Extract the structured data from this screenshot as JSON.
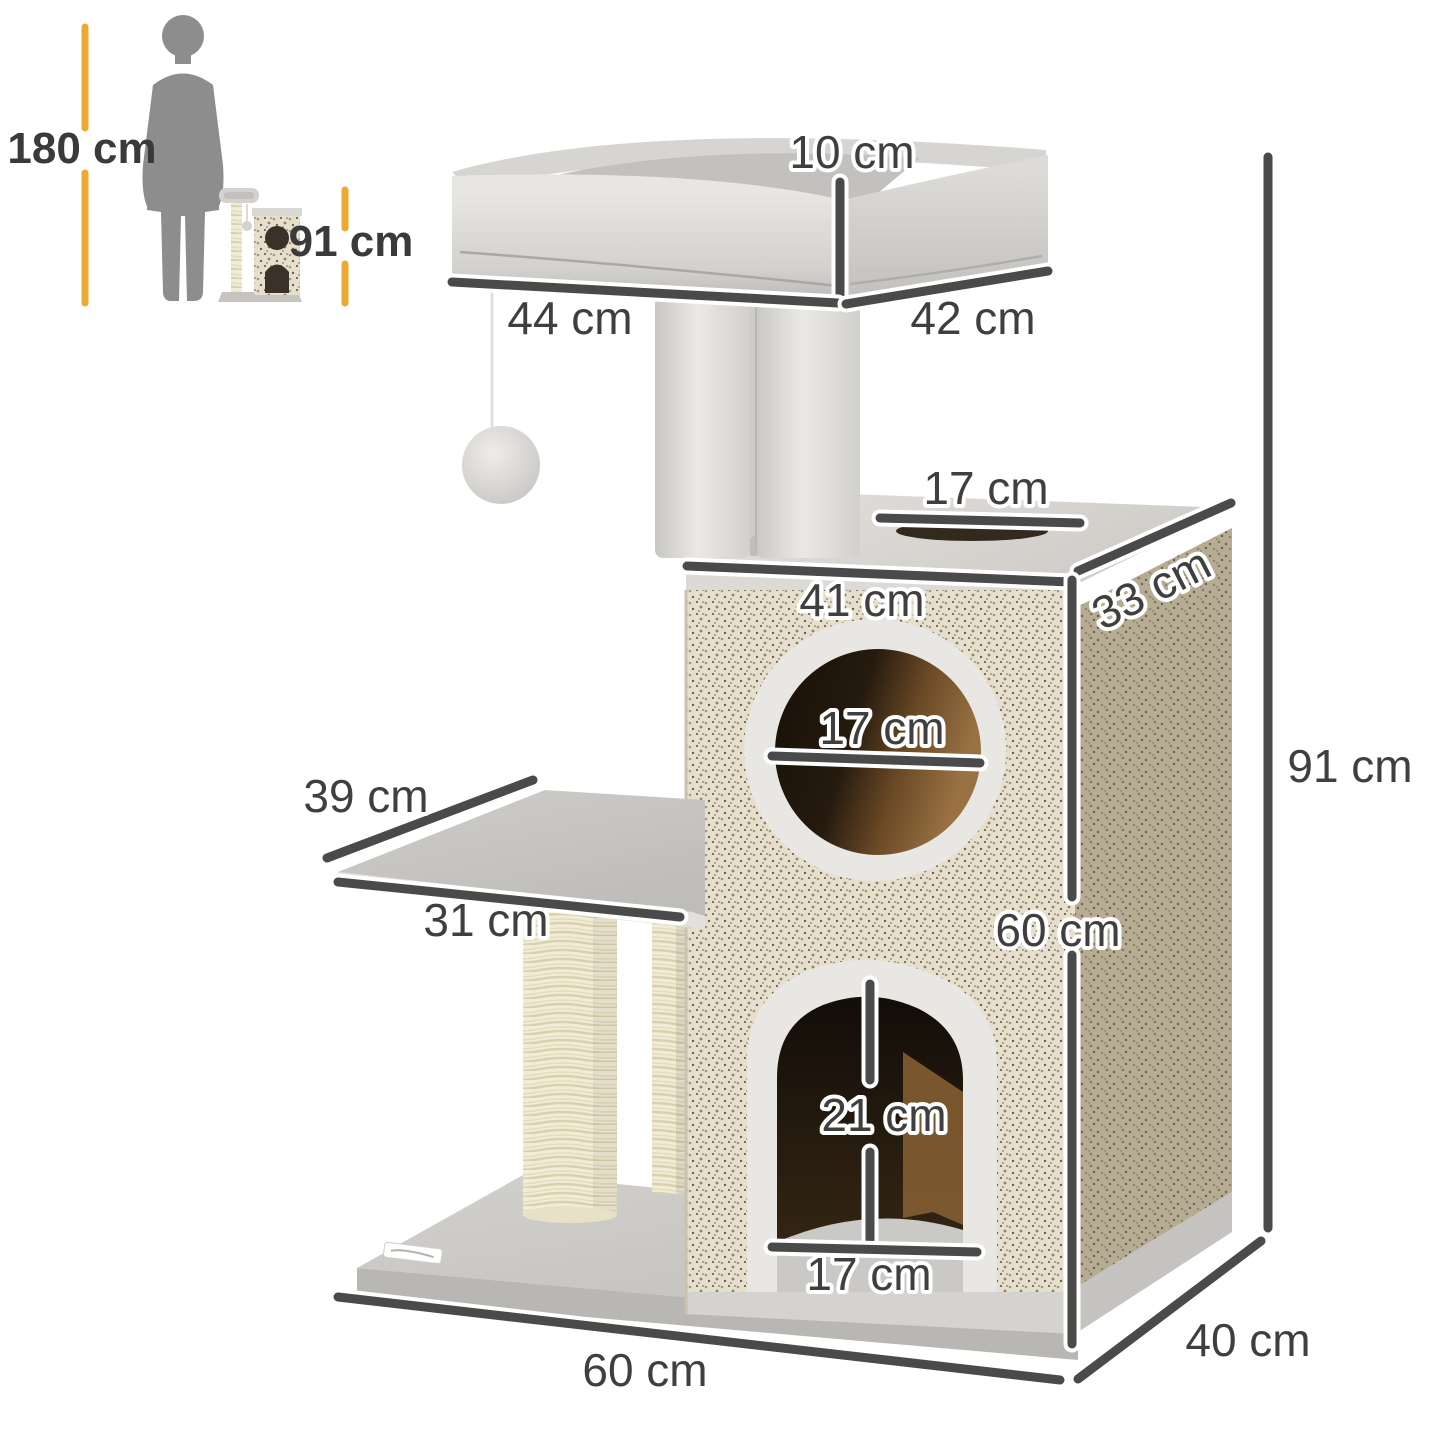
{
  "page": {
    "background": "#ffffff",
    "description": "Cat tree product dimension diagram with human size comparison"
  },
  "inset": {
    "human_height": "180 cm",
    "product_height": "91 cm"
  },
  "dimensions": {
    "top_bed_rim_height": "10 cm",
    "top_bed_width": "44 cm",
    "top_bed_depth": "42 cm",
    "top_hole_diameter": "17 cm",
    "condo_width": "41 cm",
    "condo_depth": "33 cm",
    "front_hole_diameter": "17 cm",
    "platform_depth": "39 cm",
    "platform_width": "31 cm",
    "door_height": "21 cm",
    "door_width": "17 cm",
    "condo_height": "60 cm",
    "overall_height": "91 cm",
    "base_width": "60 cm",
    "base_depth": "40 cm"
  },
  "colors": {
    "accent_yellow": "#ecaa32",
    "dimension_line": "#4a4a4a",
    "label_text": "#3f3f3f",
    "silhouette_gray": "#8d8d8d",
    "plush_gray": "#d9d7d3",
    "sisal_front": "#e6dfcd",
    "sisal_side": "#b6ac93",
    "post_cream": "#f1ecd6",
    "hole_interior": "#6e4c26"
  }
}
